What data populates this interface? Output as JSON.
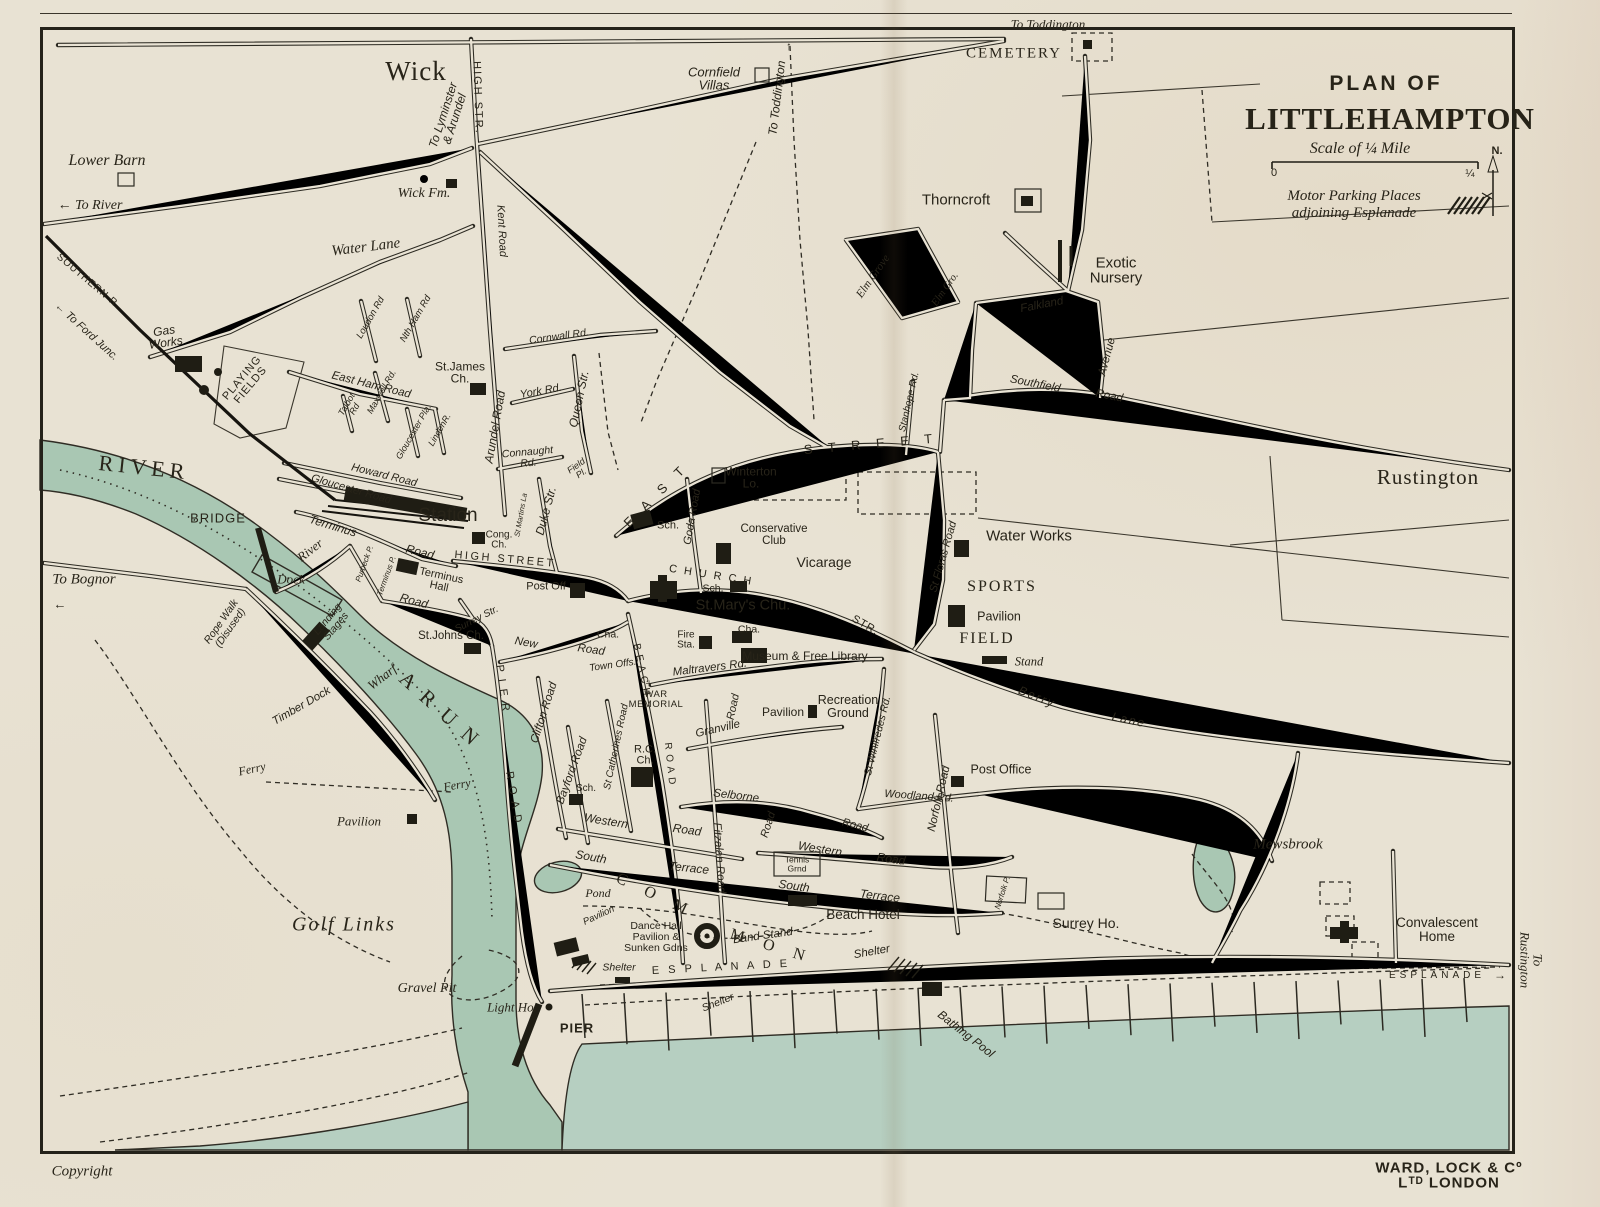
{
  "title_block": {
    "kicker": "PLAN OF",
    "title": "LITTLEHAMPTON",
    "scale_label": "Scale of ¼ Mile",
    "scale_start": "0",
    "scale_end": "¼",
    "north": "N.",
    "parking_note": "Motor Parking Places\nadjoining Esplanade"
  },
  "footer": {
    "copyright": "Copyright",
    "publisher": "WARD, LOCK & Cº Lᵀᴰ LONDON"
  },
  "colors": {
    "paper": "#e8e2d3",
    "ink": "#2b2820",
    "river": "#a9c7b3",
    "sea": "#b6cfc1",
    "building": "#1f1d14"
  },
  "labels": [
    {
      "t": "To Toddington",
      "x": 1048,
      "y": 24,
      "s": 13,
      "c": "si"
    },
    {
      "t": "Wick",
      "x": 416,
      "y": 72,
      "s": 27,
      "c": "se",
      "ls": 1
    },
    {
      "t": "To Lyminster\n& Arundel",
      "x": 449,
      "y": 117,
      "r": -72,
      "s": 12,
      "c": "h"
    },
    {
      "t": "HIGH STR.",
      "x": 477,
      "y": 98,
      "r": 88,
      "s": 11,
      "c": "c",
      "ls": 2
    },
    {
      "t": "Cornfield\nVillas",
      "x": 714,
      "y": 79,
      "s": 13,
      "c": "h"
    },
    {
      "t": "To Toddington",
      "x": 777,
      "y": 98,
      "r": -83,
      "s": 12,
      "c": "h"
    },
    {
      "t": "↑",
      "x": 789,
      "y": 46,
      "s": 12,
      "c": "hs"
    },
    {
      "t": "CEMETERY",
      "x": 1014,
      "y": 54,
      "s": 15,
      "c": "sc",
      "ls": 2
    },
    {
      "t": "Lower Barn",
      "x": 107,
      "y": 161,
      "s": 16,
      "c": "si"
    },
    {
      "t": "Wick Fm.",
      "x": 424,
      "y": 194,
      "s": 14,
      "c": "si"
    },
    {
      "t": "← To River",
      "x": 90,
      "y": 206,
      "s": 14,
      "c": "si"
    },
    {
      "t": "Thorncroft",
      "x": 956,
      "y": 200,
      "s": 15,
      "c": "hs"
    },
    {
      "t": "Water Lane",
      "x": 366,
      "y": 248,
      "r": -7,
      "s": 15,
      "c": "si"
    },
    {
      "t": "Kent Road",
      "x": 501,
      "y": 231,
      "r": 87,
      "s": 11,
      "c": "h"
    },
    {
      "t": "Exotic\nNursery",
      "x": 1116,
      "y": 271,
      "s": 15,
      "c": "hs"
    },
    {
      "t": "Elm Grove",
      "x": 874,
      "y": 277,
      "r": -55,
      "s": 11.5,
      "c": "si"
    },
    {
      "t": "Elm Gro.",
      "x": 946,
      "y": 290,
      "r": -55,
      "s": 10.5,
      "c": "si"
    },
    {
      "t": "SOUTHERN R.",
      "x": 88,
      "y": 282,
      "r": 40,
      "s": 10,
      "c": "c",
      "ls": 1
    },
    {
      "t": "← To Ford Junc.",
      "x": 86,
      "y": 332,
      "r": 42,
      "s": 11,
      "c": "h"
    },
    {
      "t": "Falkland",
      "x": 1042,
      "y": 306,
      "r": -11,
      "s": 11.5,
      "c": "h"
    },
    {
      "t": "Avenue",
      "x": 1108,
      "y": 357,
      "r": -75,
      "s": 11.5,
      "c": "h"
    },
    {
      "t": "Loudon Rd",
      "x": 371,
      "y": 318,
      "r": -60,
      "s": 9.5,
      "c": "h"
    },
    {
      "t": "Nth Ham Rd",
      "x": 416,
      "y": 319,
      "r": -60,
      "s": 9.5,
      "c": "h"
    },
    {
      "t": "Gas\nWorks",
      "x": 165,
      "y": 337,
      "r": -8,
      "s": 12,
      "c": "h"
    },
    {
      "t": "Cornwall Rd.",
      "x": 559,
      "y": 337,
      "r": -8,
      "s": 10.5,
      "c": "h"
    },
    {
      "t": "St.James\nCh.",
      "x": 460,
      "y": 373,
      "s": 12,
      "c": "hs"
    },
    {
      "t": "PLAYING\nFIELDS",
      "x": 247,
      "y": 382,
      "r": -50,
      "s": 11,
      "c": "c",
      "ls": 1
    },
    {
      "t": "East Ham Road",
      "x": 371,
      "y": 386,
      "r": 14,
      "s": 11.5,
      "c": "h"
    },
    {
      "t": "Southfield",
      "x": 1035,
      "y": 385,
      "r": 11,
      "s": 11.5,
      "c": "h"
    },
    {
      "t": "Road",
      "x": 1109,
      "y": 397,
      "r": 11,
      "s": 11.5,
      "c": "h"
    },
    {
      "t": "York Rd.",
      "x": 541,
      "y": 392,
      "r": -10,
      "s": 11,
      "c": "h"
    },
    {
      "t": "Maxwell Rd.",
      "x": 382,
      "y": 392,
      "r": -60,
      "s": 9,
      "c": "h"
    },
    {
      "t": "Talbot\nRd",
      "x": 351,
      "y": 407,
      "r": -60,
      "s": 9,
      "c": "h"
    },
    {
      "t": "Queen Str.",
      "x": 579,
      "y": 399,
      "r": -78,
      "s": 12,
      "c": "h"
    },
    {
      "t": "Stanhope Rd.",
      "x": 910,
      "y": 402,
      "r": -77,
      "s": 10,
      "c": "h"
    },
    {
      "t": "Rustington",
      "x": 1428,
      "y": 478,
      "s": 21,
      "c": "se",
      "ls": 1
    },
    {
      "t": "Gloucester Pla.",
      "x": 414,
      "y": 432,
      "r": -60,
      "s": 9,
      "c": "h"
    },
    {
      "t": "LindenR.",
      "x": 440,
      "y": 430,
      "r": -60,
      "s": 9,
      "c": "h"
    },
    {
      "t": "Arundel Road",
      "x": 495,
      "y": 427,
      "r": -80,
      "s": 12,
      "c": "h"
    },
    {
      "t": "Connaught\nRd.",
      "x": 528,
      "y": 458,
      "r": -5,
      "s": 10.5,
      "c": "h"
    },
    {
      "t": "RIVER",
      "x": 144,
      "y": 468,
      "r": 6,
      "s": 22,
      "c": "sc",
      "ls": 5
    },
    {
      "t": "Howard Road",
      "x": 384,
      "y": 476,
      "r": 14,
      "s": 11,
      "c": "h"
    },
    {
      "t": "Gloucester Road",
      "x": 351,
      "y": 490,
      "r": 16,
      "s": 11,
      "c": "h"
    },
    {
      "t": "E A S T",
      "x": 656,
      "y": 495,
      "r": -45,
      "s": 13,
      "c": "c",
      "ls": 6
    },
    {
      "t": "S T R E E T",
      "x": 871,
      "y": 444,
      "r": -5,
      "s": 13,
      "c": "c",
      "ls": 6
    },
    {
      "t": "Winterton\nLo.",
      "x": 751,
      "y": 478,
      "s": 12,
      "c": "hs"
    },
    {
      "t": "Field\nPl.",
      "x": 579,
      "y": 470,
      "r": -35,
      "s": 9,
      "c": "h"
    },
    {
      "t": "St Floras Road",
      "x": 944,
      "y": 557,
      "r": -74,
      "s": 11,
      "c": "h"
    },
    {
      "t": "Water Works",
      "x": 1029,
      "y": 536,
      "s": 15,
      "c": "hs"
    },
    {
      "t": "Duke Str.",
      "x": 546,
      "y": 511,
      "r": -75,
      "s": 12,
      "c": "h"
    },
    {
      "t": "Goda Road",
      "x": 693,
      "y": 517,
      "r": -80,
      "s": 11,
      "c": "h"
    },
    {
      "t": "Sch.",
      "x": 668,
      "y": 526,
      "s": 11,
      "c": "hs"
    },
    {
      "t": "St Martins La",
      "x": 521,
      "y": 515,
      "r": -80,
      "s": 7.5,
      "c": "h"
    },
    {
      "t": "Station",
      "x": 448,
      "y": 516,
      "s": 19,
      "c": "hs"
    },
    {
      "t": "BRIDGE",
      "x": 218,
      "y": 518,
      "s": 13,
      "c": "c",
      "ls": 1
    },
    {
      "t": "Conservative\nClub",
      "x": 774,
      "y": 536,
      "s": 11.5,
      "c": "hs"
    },
    {
      "t": "Cong.\nCh.",
      "x": 499,
      "y": 541,
      "s": 10,
      "c": "hs"
    },
    {
      "t": "Terminus",
      "x": 333,
      "y": 526,
      "r": 17,
      "s": 12,
      "c": "h"
    },
    {
      "t": "Road",
      "x": 420,
      "y": 552,
      "r": 14,
      "s": 12,
      "c": "h"
    },
    {
      "t": "River",
      "x": 310,
      "y": 550,
      "r": -38,
      "s": 13,
      "c": "si"
    },
    {
      "t": "HIGH STREET",
      "x": 505,
      "y": 560,
      "r": 5,
      "s": 11,
      "c": "c",
      "ls": 2.5
    },
    {
      "t": "Vicarage",
      "x": 824,
      "y": 562,
      "s": 14,
      "c": "hs"
    },
    {
      "t": "SPORTS",
      "x": 1002,
      "y": 587,
      "s": 16,
      "c": "sc",
      "ls": 2
    },
    {
      "t": "Purbeck P.",
      "x": 365,
      "y": 564,
      "r": -70,
      "s": 8,
      "c": "h"
    },
    {
      "t": "Terminus P.",
      "x": 387,
      "y": 576,
      "r": -70,
      "s": 8,
      "c": "h"
    },
    {
      "t": "Terminus\nHall",
      "x": 440,
      "y": 582,
      "r": 12,
      "s": 11,
      "c": "hs"
    },
    {
      "t": "Dock",
      "x": 291,
      "y": 579,
      "s": 13,
      "c": "si"
    },
    {
      "t": "Post Off",
      "x": 546,
      "y": 587,
      "s": 11,
      "c": "hs"
    },
    {
      "t": "C H U R C H",
      "x": 711,
      "y": 576,
      "r": 9,
      "s": 11,
      "c": "c",
      "ls": 2
    },
    {
      "t": "Sch.",
      "x": 713,
      "y": 589,
      "s": 10.5,
      "c": "hs"
    },
    {
      "t": "To Bognor",
      "x": 84,
      "y": 580,
      "s": 15,
      "c": "si"
    },
    {
      "t": "←",
      "x": 60,
      "y": 604,
      "s": 13,
      "c": "hs"
    },
    {
      "t": "St.Mary's Chu.",
      "x": 743,
      "y": 606,
      "s": 14.5,
      "c": "hs"
    },
    {
      "t": "Road",
      "x": 414,
      "y": 601,
      "r": 15,
      "s": 12,
      "c": "h"
    },
    {
      "t": "Surrey Str.",
      "x": 477,
      "y": 620,
      "r": -27,
      "s": 10,
      "c": "h"
    },
    {
      "t": "STR.",
      "x": 865,
      "y": 626,
      "r": 30,
      "s": 11,
      "c": "c",
      "ls": 1
    },
    {
      "t": "Pavilion",
      "x": 999,
      "y": 617,
      "s": 12.5,
      "c": "hs"
    },
    {
      "t": "Landing\nStages",
      "x": 332,
      "y": 623,
      "r": -50,
      "s": 10.5,
      "c": "h"
    },
    {
      "t": "Rope Walk\n(Disused)",
      "x": 226,
      "y": 625,
      "r": -55,
      "s": 10.5,
      "c": "h"
    },
    {
      "t": "St.Johns Ch.",
      "x": 451,
      "y": 637,
      "s": 11.5,
      "c": "hs"
    },
    {
      "t": "Cha.",
      "x": 608,
      "y": 635,
      "s": 10.5,
      "c": "hs"
    },
    {
      "t": "Cha.",
      "x": 749,
      "y": 630,
      "s": 10.5,
      "c": "hs"
    },
    {
      "t": "FIELD",
      "x": 987,
      "y": 639,
      "s": 16,
      "c": "sc",
      "ls": 2
    },
    {
      "t": "Fire\nSta.",
      "x": 686,
      "y": 641,
      "s": 10,
      "c": "hs"
    },
    {
      "t": "New",
      "x": 526,
      "y": 644,
      "r": 10,
      "s": 11.5,
      "c": "h"
    },
    {
      "t": "Road",
      "x": 591,
      "y": 651,
      "r": 8,
      "s": 11.5,
      "c": "h"
    },
    {
      "t": "Museum & Free Library",
      "x": 805,
      "y": 656,
      "s": 12,
      "c": "hs"
    },
    {
      "t": "Stand",
      "x": 1029,
      "y": 662,
      "s": 12.5,
      "c": "si"
    },
    {
      "t": "Town Offs.",
      "x": 613,
      "y": 666,
      "r": -8,
      "s": 10,
      "c": "h"
    },
    {
      "t": "Maltravers Rd.",
      "x": 710,
      "y": 669,
      "r": -7,
      "s": 11.5,
      "c": "h"
    },
    {
      "t": "Wharf",
      "x": 382,
      "y": 677,
      "r": -38,
      "s": 13,
      "c": "si"
    },
    {
      "t": "WAR\nMEMORIAL",
      "x": 656,
      "y": 700,
      "s": 9.5,
      "c": "c",
      "ls": 0.5
    },
    {
      "t": "+",
      "x": 649,
      "y": 683,
      "s": 13,
      "c": "se"
    },
    {
      "t": "Berry",
      "x": 1037,
      "y": 697,
      "r": 22,
      "s": 12,
      "c": "h",
      "ls": 2
    },
    {
      "t": "Lane",
      "x": 1129,
      "y": 720,
      "r": 12,
      "s": 12,
      "c": "h",
      "ls": 2
    },
    {
      "t": "A R U N",
      "x": 440,
      "y": 710,
      "r": 42,
      "s": 21,
      "c": "sc",
      "ls": 4
    },
    {
      "t": "Recreation\nGround",
      "x": 848,
      "y": 707,
      "s": 12.5,
      "c": "hs"
    },
    {
      "t": "Pavilion",
      "x": 783,
      "y": 712,
      "s": 12,
      "c": "hs"
    },
    {
      "t": "P I E R",
      "x": 502,
      "y": 689,
      "r": 82,
      "s": 11,
      "c": "c",
      "ls": 2
    },
    {
      "t": "R O A D",
      "x": 513,
      "y": 798,
      "r": 80,
      "s": 11,
      "c": "c",
      "ls": 2
    },
    {
      "t": "Granville",
      "x": 718,
      "y": 730,
      "r": -13,
      "s": 11.5,
      "c": "h"
    },
    {
      "t": "Road",
      "x": 734,
      "y": 707,
      "r": -78,
      "s": 11,
      "c": "h"
    },
    {
      "t": "Timber Dock",
      "x": 302,
      "y": 707,
      "r": -30,
      "s": 11.5,
      "c": "h"
    },
    {
      "t": "Clifton Road",
      "x": 545,
      "y": 713,
      "r": -72,
      "s": 11.5,
      "c": "h"
    },
    {
      "t": "Bayford Road",
      "x": 573,
      "y": 771,
      "r": -70,
      "s": 11.5,
      "c": "h"
    },
    {
      "t": "B E A C H",
      "x": 641,
      "y": 670,
      "r": 78,
      "s": 10,
      "c": "c",
      "ls": 1
    },
    {
      "t": "R O A D",
      "x": 669,
      "y": 764,
      "r": 84,
      "s": 10,
      "c": "c",
      "ls": 1
    },
    {
      "t": "St Catherines Road",
      "x": 617,
      "y": 747,
      "r": -78,
      "s": 10,
      "c": "h"
    },
    {
      "t": "St Winifredes Rd.",
      "x": 878,
      "y": 736,
      "r": -76,
      "s": 10.5,
      "c": "h"
    },
    {
      "t": "Norfolk Road",
      "x": 940,
      "y": 799,
      "r": -77,
      "s": 11.5,
      "c": "h"
    },
    {
      "t": "R.C.\nCh.",
      "x": 645,
      "y": 756,
      "s": 11,
      "c": "hs"
    },
    {
      "t": "Ferry",
      "x": 252,
      "y": 769,
      "r": -12,
      "s": 12,
      "c": "si"
    },
    {
      "t": "Ferry",
      "x": 457,
      "y": 785,
      "r": -10,
      "s": 12,
      "c": "si"
    },
    {
      "t": "Post Office",
      "x": 1001,
      "y": 770,
      "s": 12.5,
      "c": "hs"
    },
    {
      "t": "Fitzalan Road",
      "x": 718,
      "y": 858,
      "r": 86,
      "s": 11.5,
      "c": "h"
    },
    {
      "t": "Selborne",
      "x": 736,
      "y": 797,
      "r": 7,
      "s": 11.5,
      "c": "h"
    },
    {
      "t": "Road",
      "x": 769,
      "y": 825,
      "r": -72,
      "s": 11,
      "c": "h"
    },
    {
      "t": "Road",
      "x": 855,
      "y": 826,
      "r": 14,
      "s": 11,
      "c": "h"
    },
    {
      "t": "Sch.",
      "x": 586,
      "y": 789,
      "s": 10,
      "c": "hs"
    },
    {
      "t": "Woodland Rd.",
      "x": 919,
      "y": 797,
      "r": 4,
      "s": 11,
      "c": "h"
    },
    {
      "t": "Pavilion",
      "x": 359,
      "y": 821,
      "s": 13,
      "c": "si"
    },
    {
      "t": "Western",
      "x": 606,
      "y": 821,
      "r": 9,
      "s": 12,
      "c": "h"
    },
    {
      "t": "Road",
      "x": 687,
      "y": 830,
      "r": 8,
      "s": 12,
      "c": "h"
    },
    {
      "t": "Western",
      "x": 820,
      "y": 849,
      "r": 9,
      "s": 12,
      "c": "h"
    },
    {
      "t": "Road",
      "x": 891,
      "y": 859,
      "r": 8,
      "s": 12,
      "c": "h"
    },
    {
      "t": "Mewsbrook",
      "x": 1288,
      "y": 845,
      "s": 15,
      "c": "si"
    },
    {
      "t": "South",
      "x": 591,
      "y": 857,
      "r": 10,
      "s": 12,
      "c": "h"
    },
    {
      "t": "Terrace",
      "x": 689,
      "y": 868,
      "r": 6,
      "s": 12,
      "c": "h"
    },
    {
      "t": "Tennis\nGrnd",
      "x": 797,
      "y": 864,
      "s": 8.5,
      "c": "hs"
    },
    {
      "t": "South",
      "x": 794,
      "y": 886,
      "r": 8,
      "s": 12,
      "c": "h"
    },
    {
      "t": "Terrace",
      "x": 880,
      "y": 896,
      "r": 7,
      "s": 12,
      "c": "h"
    },
    {
      "t": "Norfolk P.",
      "x": 1003,
      "y": 893,
      "r": -72,
      "s": 8,
      "c": "h"
    },
    {
      "t": "Beach Hotel",
      "x": 863,
      "y": 915,
      "s": 13.5,
      "c": "hs"
    },
    {
      "t": "Surrey Ho.",
      "x": 1086,
      "y": 923,
      "s": 14,
      "c": "hs"
    },
    {
      "t": "Golf Links",
      "x": 344,
      "y": 925,
      "s": 20,
      "c": "si",
      "ls": 2
    },
    {
      "t": "Pond",
      "x": 598,
      "y": 893,
      "s": 12,
      "c": "si"
    },
    {
      "t": "C O M",
      "x": 655,
      "y": 896,
      "r": 25,
      "s": 16,
      "c": "sc",
      "ls": 8
    },
    {
      "t": "M O N",
      "x": 771,
      "y": 947,
      "r": 17,
      "s": 16,
      "c": "sc",
      "ls": 8
    },
    {
      "t": "Pavilion",
      "x": 599,
      "y": 916,
      "r": -25,
      "s": 9.5,
      "c": "h"
    },
    {
      "t": "Dance Hall\nPavilion &\nSunken Gdns",
      "x": 656,
      "y": 937,
      "s": 10.5,
      "c": "hs"
    },
    {
      "t": "Band Stand",
      "x": 763,
      "y": 937,
      "r": -8,
      "s": 11.5,
      "c": "h"
    },
    {
      "t": "Convalescent\nHome",
      "x": 1437,
      "y": 930,
      "s": 13.5,
      "c": "hs"
    },
    {
      "t": "Shelter",
      "x": 619,
      "y": 968,
      "s": 10.5,
      "c": "h"
    },
    {
      "t": "E S P L A N A D E",
      "x": 721,
      "y": 968,
      "r": -3,
      "s": 11,
      "c": "c",
      "ls": 3
    },
    {
      "t": "Shelter",
      "x": 872,
      "y": 953,
      "r": -10,
      "s": 11.5,
      "c": "h"
    },
    {
      "t": "ESPLANADE",
      "x": 1437,
      "y": 976,
      "s": 10,
      "c": "c",
      "ls": 4
    },
    {
      "t": "→",
      "x": 1500,
      "y": 975,
      "s": 12,
      "c": "hs"
    },
    {
      "t": "To Rustington",
      "x": 1531,
      "y": 960,
      "r": 90,
      "s": 13,
      "c": "si"
    },
    {
      "t": "Gravel Pit",
      "x": 427,
      "y": 989,
      "s": 14,
      "c": "si"
    },
    {
      "t": "Light Ho.",
      "x": 512,
      "y": 1007,
      "s": 13,
      "c": "si"
    },
    {
      "t": "Shelter",
      "x": 718,
      "y": 1003,
      "r": -22,
      "s": 10.5,
      "c": "h"
    },
    {
      "t": "PIER",
      "x": 577,
      "y": 1028,
      "s": 13,
      "c": "c",
      "ls": 1,
      "b": 1
    },
    {
      "t": "Bathing Pool",
      "x": 966,
      "y": 1034,
      "r": 38,
      "s": 12,
      "c": "h"
    }
  ]
}
